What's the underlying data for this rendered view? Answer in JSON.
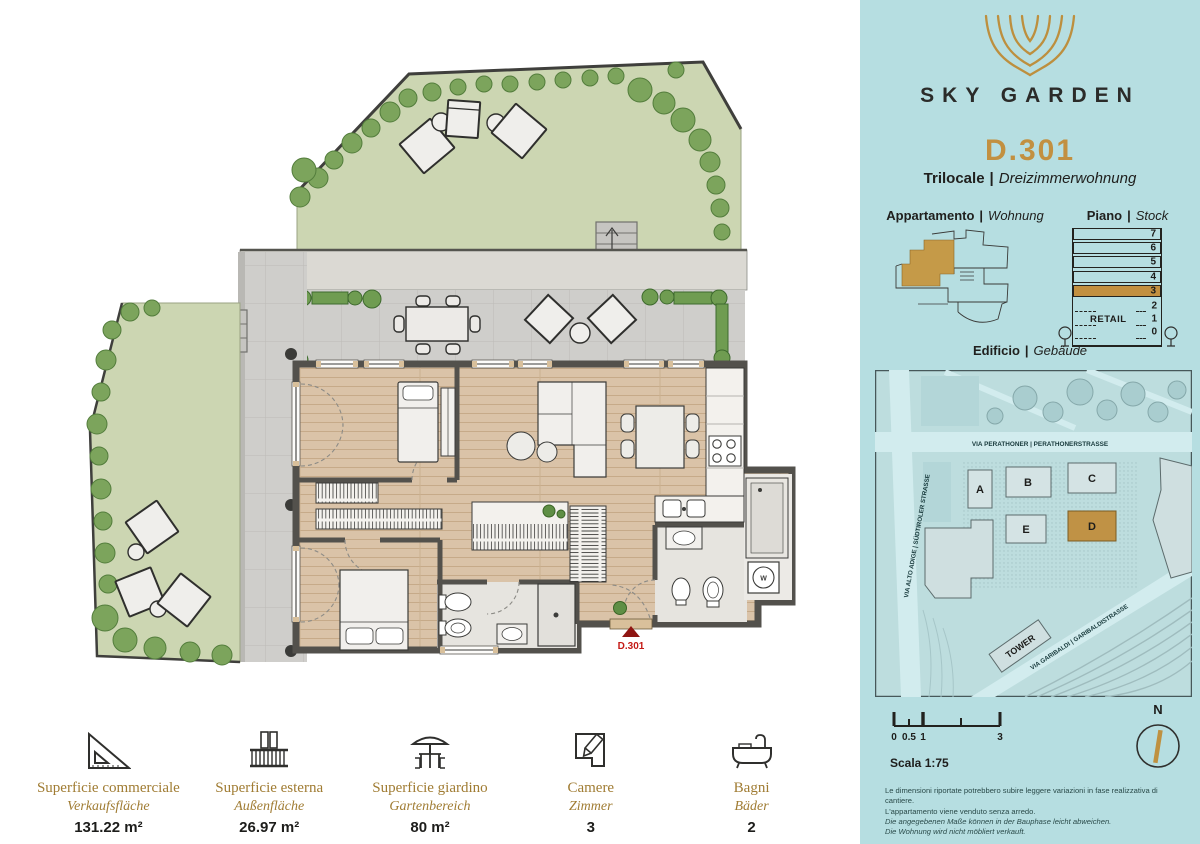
{
  "sep": "|",
  "colors": {
    "panel_teal": "#b6dee1",
    "accent_gold": "#c29040",
    "marker_red": "#b11915",
    "wall_gray": "#53514c",
    "lawn_green": "#ccd6b2"
  },
  "brand": {
    "name": "SKY GARDEN"
  },
  "unit": {
    "code": "D.301",
    "type_it": "Trilocale",
    "type_de": "Dreizimmerwohnung"
  },
  "sections": {
    "apartment": {
      "it": "Appartamento",
      "de": "Wohnung"
    },
    "floor": {
      "it": "Piano",
      "de": "Stock"
    },
    "building": {
      "it": "Edificio",
      "de": "Gebäude"
    }
  },
  "floor_stack": {
    "floors": [
      "7",
      "6",
      "5",
      "4",
      "3",
      "2",
      "1",
      "0"
    ],
    "highlighted_floor": "3",
    "retail_label": "RETAIL"
  },
  "site_map": {
    "buildings": [
      "A",
      "B",
      "C",
      "D",
      "E"
    ],
    "highlighted_building": "D",
    "tower_label": "TOWER",
    "streets": {
      "north": "VIA PERATHONER | PERATHONERSTRASSE",
      "west": "VIA ALTO ADIGE | SÜDTIROLER STRASSE",
      "southeast": "VIA GARIBALDI | GARIBALDISTRASSE"
    }
  },
  "plan": {
    "entrance_label": "D.301",
    "washer_label": "W"
  },
  "scale_bar": {
    "label": "Scala 1:75",
    "ticks": [
      "0",
      "0.5",
      "1",
      "3"
    ]
  },
  "compass": {
    "north_label": "N"
  },
  "stats": [
    {
      "icon": "set-square-icon",
      "label_it": "Superficie commerciale",
      "label_de": "Verkaufsfläche",
      "value": "131.22 m²"
    },
    {
      "icon": "balcony-icon",
      "label_it": "Superficie esterna",
      "label_de": "Außenfläche",
      "value": "26.97 m²"
    },
    {
      "icon": "garden-icon",
      "label_it": "Superficie giardino",
      "label_de": "Gartenbereich",
      "value": "80 m²"
    },
    {
      "icon": "rooms-icon",
      "label_it": "Camere",
      "label_de": "Zimmer",
      "value": "3"
    },
    {
      "icon": "bath-icon",
      "label_it": "Bagni",
      "label_de": "Bäder",
      "value": "2"
    }
  ],
  "disclaimer": {
    "lines": [
      "Le dimensioni riportate potrebbero subire leggere variazioni in fase realizzativa di cantiere.",
      "L'appartamento viene venduto senza arredo.",
      "Die angegebenen Maße können in der Bauphase leicht abweichen.",
      "Die Wohnung wird nicht möbliert verkauft."
    ]
  }
}
